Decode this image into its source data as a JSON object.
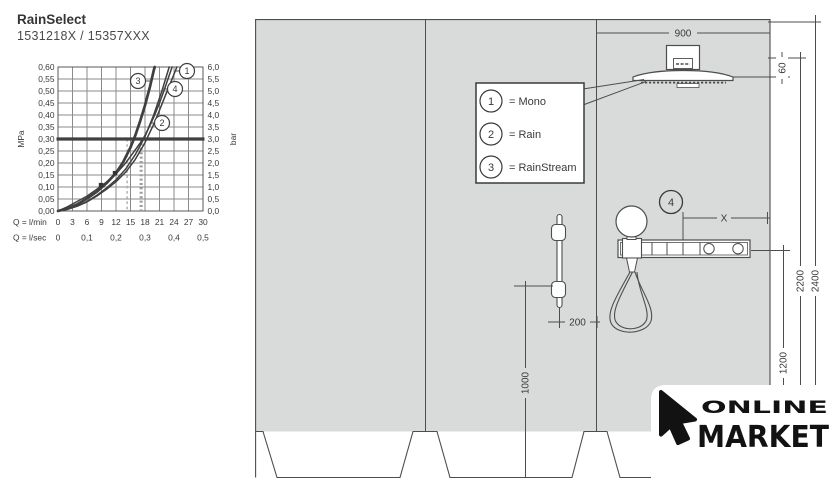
{
  "header": {
    "title": "RainSelect",
    "subtitle": "1531218X / 15357XXX"
  },
  "chart_data": {
    "type": "line",
    "title": "Flow rate vs. pressure diagram",
    "xlabel_primary": "Q = l/min",
    "xlabel_secondary": "Q = l/sec",
    "ylabel_left": "MPa",
    "ylabel_right": "bar",
    "xlim_lmin": [
      0,
      30
    ],
    "ylim_mpa": [
      0,
      0.6
    ],
    "grid": "on",
    "x_ticks_lmin": [
      "0",
      "3",
      "6",
      "9",
      "12",
      "15",
      "18",
      "21",
      "24",
      "27",
      "30"
    ],
    "x_ticks_lsec": [
      "0",
      "0,1",
      "0,2",
      "0,3",
      "0,4",
      "0,5"
    ],
    "y_ticks_mpa": [
      "0,60",
      "0,55",
      "0,50",
      "0,45",
      "0,40",
      "0,35",
      "0,30",
      "0,25",
      "0,20",
      "0,15",
      "0,10",
      "0,05",
      "0,00"
    ],
    "y_ticks_bar": [
      "6,0",
      "5,5",
      "5,0",
      "4,5",
      "4,0",
      "3,5",
      "3,0",
      "2,5",
      "2,0",
      "1,5",
      "1,0",
      "0,5",
      "0,0"
    ],
    "reference_pressure_mpa": 0.3,
    "flow_guides_lmin": [
      14.3,
      17.2
    ],
    "markers": [
      [
        8.9,
        0.108
      ],
      [
        11.8,
        0.158
      ]
    ],
    "series": [
      {
        "name": "1",
        "points": [
          [
            0,
            0
          ],
          [
            2,
            0.008
          ],
          [
            4,
            0.02
          ],
          [
            6,
            0.038
          ],
          [
            8,
            0.062
          ],
          [
            10,
            0.09
          ],
          [
            12,
            0.122
          ],
          [
            14,
            0.162
          ],
          [
            16,
            0.215
          ],
          [
            18,
            0.285
          ],
          [
            20,
            0.37
          ],
          [
            22,
            0.47
          ],
          [
            23.5,
            0.545
          ],
          [
            24.6,
            0.6
          ]
        ]
      },
      {
        "name": "2",
        "points": [
          [
            0,
            0
          ],
          [
            2,
            0.018
          ],
          [
            4,
            0.04
          ],
          [
            6,
            0.062
          ],
          [
            8,
            0.09
          ],
          [
            10,
            0.12
          ],
          [
            12,
            0.155
          ],
          [
            14,
            0.2
          ],
          [
            16,
            0.255
          ],
          [
            17.6,
            0.3
          ],
          [
            19,
            0.355
          ],
          [
            20,
            0.4
          ],
          [
            21,
            0.45
          ],
          [
            22,
            0.505
          ],
          [
            23,
            0.565
          ],
          [
            23.6,
            0.6
          ]
        ]
      },
      {
        "name": "3",
        "points": [
          [
            0,
            0
          ],
          [
            2,
            0.01
          ],
          [
            4,
            0.028
          ],
          [
            6,
            0.052
          ],
          [
            8,
            0.08
          ],
          [
            10,
            0.115
          ],
          [
            12,
            0.158
          ],
          [
            13.5,
            0.205
          ],
          [
            15,
            0.265
          ],
          [
            16,
            0.315
          ],
          [
            17,
            0.375
          ],
          [
            18,
            0.44
          ],
          [
            19,
            0.515
          ],
          [
            19.8,
            0.585
          ],
          [
            20,
            0.6
          ]
        ]
      },
      {
        "name": "4",
        "points": [
          [
            0,
            0
          ],
          [
            2,
            0.008
          ],
          [
            4,
            0.021
          ],
          [
            6,
            0.04
          ],
          [
            8,
            0.065
          ],
          [
            10,
            0.095
          ],
          [
            12,
            0.13
          ],
          [
            14,
            0.175
          ],
          [
            16,
            0.235
          ],
          [
            18,
            0.31
          ],
          [
            19.8,
            0.4
          ],
          [
            21.5,
            0.5
          ],
          [
            23,
            0.6
          ]
        ]
      }
    ]
  },
  "legend": {
    "items": [
      {
        "num": "1",
        "label": "= Mono"
      },
      {
        "num": "2",
        "label": "= Rain"
      },
      {
        "num": "3",
        "label": "= RainStream"
      }
    ]
  },
  "dimensions": {
    "width": "900",
    "head_drop": "60",
    "height_total": "2400",
    "height_head": "2200",
    "height_trim": "1200",
    "bar_bottom_height": "1000",
    "bar_offset": "200",
    "x_dim": "X",
    "item_4": "4"
  },
  "logo": {
    "line1": "ONLINE",
    "line2": "MARKET"
  },
  "colors": {
    "wall": "#d9dbdb",
    "line": "#4d4d4f",
    "text": "#3a3a3c"
  }
}
